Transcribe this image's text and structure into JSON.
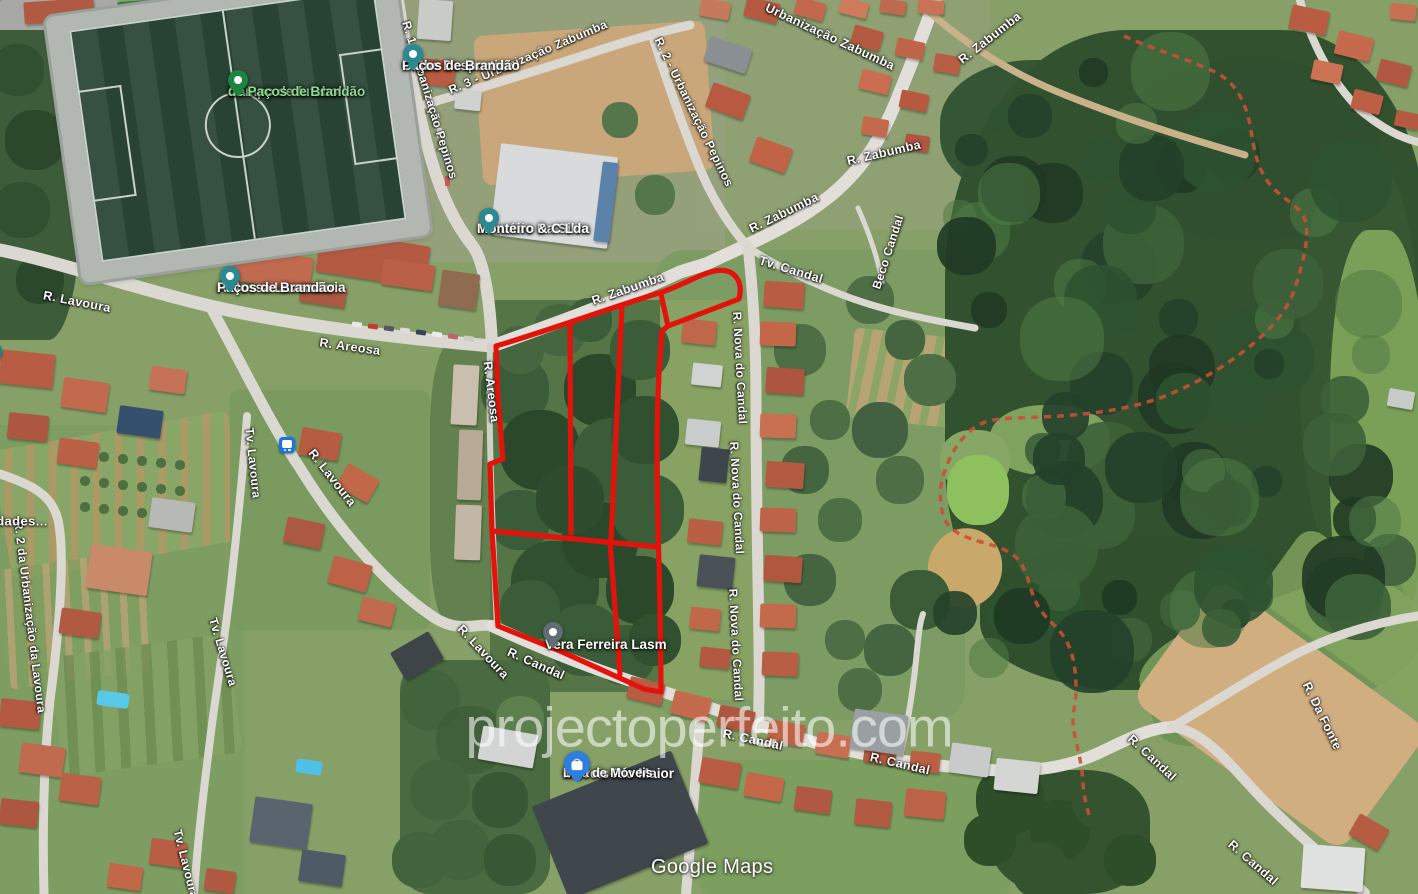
{
  "app": {
    "watermark": "projectoperfeito.com",
    "attribution": "Google Maps"
  },
  "overlay": {
    "plot_outline_color": "#e3120b",
    "admin_boundary_color": "#c94f38"
  },
  "pin_colors": {
    "park": "#1d8440",
    "poi": "#2b8a8f",
    "poi_grey": "#5f6d74",
    "shopping": "#2f7de1",
    "bus": "#1a73e8",
    "school": "#0e8b8f"
  },
  "street_labels": [
    {
      "text": "R. 1 - Urbanização Pepinos"
    },
    {
      "text": "R. 3 - Urbanização Zabumba"
    },
    {
      "text": "R. 2 - Urbanização Pepinos"
    },
    {
      "text": "Urbanização Zabumba"
    },
    {
      "text": "R. Zabumba"
    },
    {
      "text": "R. Zabumba"
    },
    {
      "text": "R. Zabumba"
    },
    {
      "text": "R. Zabumba"
    },
    {
      "text": "Tv. Candal"
    },
    {
      "text": "Beco Candal"
    },
    {
      "text": "R. Nova do Candal"
    },
    {
      "text": "R. Nova do Candal"
    },
    {
      "text": "R. Nova do Candal"
    },
    {
      "text": "R. Areosa"
    },
    {
      "text": "R. Areosa"
    },
    {
      "text": "R. Lavoura"
    },
    {
      "text": "R. Lavoura"
    },
    {
      "text": "R. Lavoura"
    },
    {
      "text": "Tv. Lavoura"
    },
    {
      "text": "Tv. Lavoura"
    },
    {
      "text": "Tv. Lavoura"
    },
    {
      "text": "R. 2 da Urbanização da Lavoura"
    },
    {
      "text": "R. Candal"
    },
    {
      "text": "R. Candal"
    },
    {
      "text": "R. Candal"
    },
    {
      "text": "R. Candal"
    },
    {
      "text": "R. Candal"
    },
    {
      "text": "R. Da Fonte"
    },
    {
      "text": "dades..."
    }
  ],
  "pois": [
    {
      "id": "campo-de-futebol",
      "lines": [
        "Campo de futebol",
        "de Paços de Brandão"
      ],
      "pin": "park"
    },
    {
      "id": "clube-desportivo",
      "lines": [
        "Clube Desportivo",
        "Paços de Brandão"
      ],
      "pin": "poi"
    },
    {
      "id": "januario-da-silva",
      "lines": [
        "Januário Da Silva",
        "Monteiro & C Lda"
      ],
      "pin": "poi"
    },
    {
      "id": "a-nossa-lavandaria",
      "lines": [
        "A Nossa Lavandaria",
        "Paços de Brandão"
      ],
      "pin": "poi"
    },
    {
      "id": "vera-ferreira",
      "lines": [
        "Vera Ferreira Lasm"
      ],
      "pin": "poi_grey"
    },
    {
      "id": "moveis-rio-maior",
      "lines": [
        "Móveis Rio Maior",
        "Loja de Móveis"
      ],
      "pin": "shopping"
    }
  ],
  "icons": [
    {
      "name": "bus-stop-icon"
    },
    {
      "name": "school-icon"
    }
  ]
}
